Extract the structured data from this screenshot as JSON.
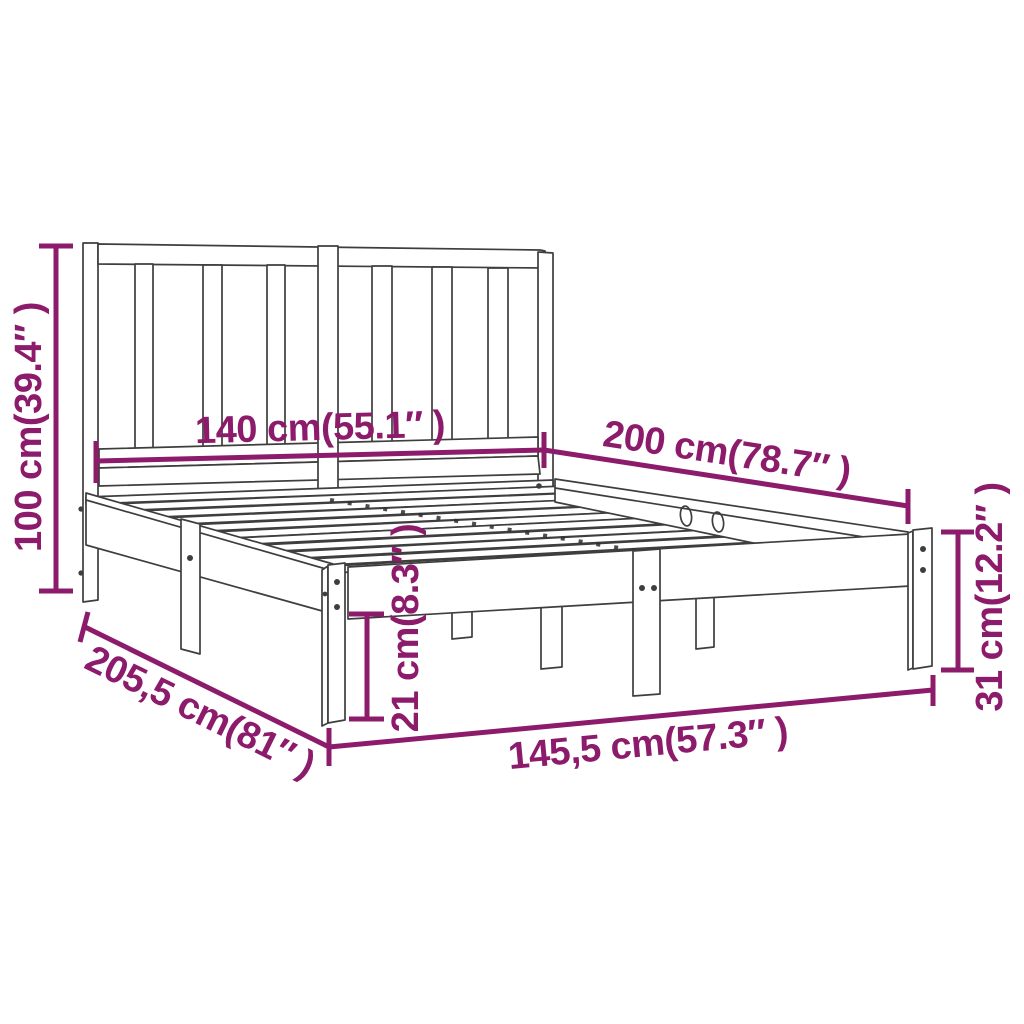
{
  "colors": {
    "dimension_accent": "#8C1B6B",
    "line_art": "#3E3E3E",
    "background": "#FFFFFF"
  },
  "figure": {
    "kind": "bed-frame-with-headboard-dimension-diagram",
    "labels": {
      "headboard_height": "100 cm(39.4″ )",
      "headboard_width": "140 cm(55.1″ )",
      "bed_length": "200 cm(78.7″ )",
      "frame_height": "31 cm(12.2″ )",
      "clearance_height": "21 cm(8.3″ )",
      "total_length": "205,5 cm(81″ )",
      "total_width": "145,5 cm(57.3″ )"
    }
  }
}
